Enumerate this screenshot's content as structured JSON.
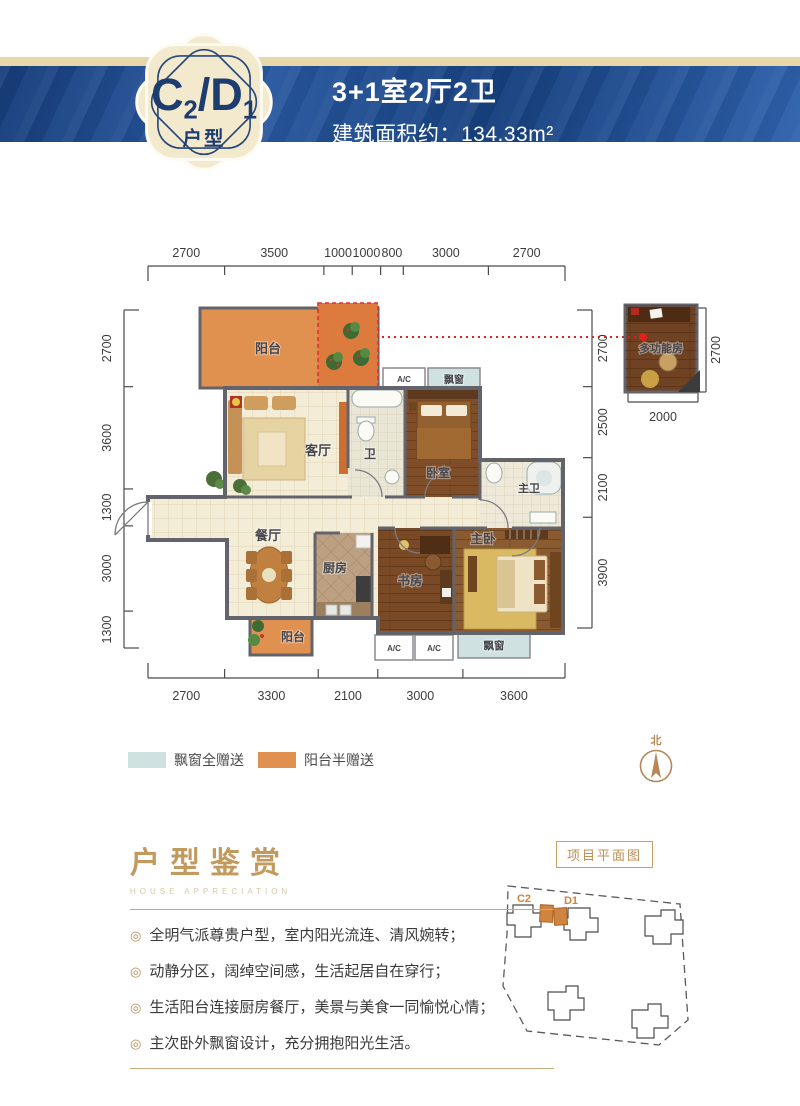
{
  "header": {
    "badge": {
      "parts": [
        "C",
        "2",
        "/D",
        "1"
      ],
      "label": "户型"
    },
    "title": "3+1室2厅2卫",
    "area_label": "建筑面积约：134.33m²"
  },
  "floorplan": {
    "rooms": {
      "balcony": "阳台",
      "living": "客厅",
      "bath": "卫",
      "bedroom": "卧室",
      "master_bath": "主卫",
      "dining": "餐厅",
      "kitchen": "厨房",
      "study": "书房",
      "master_bedroom": "主卧",
      "bay_window": "飘窗",
      "ac": "A/C",
      "annex": "多功能房"
    },
    "dims": {
      "top": [
        2700,
        3500,
        1000,
        1000,
        800,
        3000,
        2700
      ],
      "bottom": [
        2700,
        3300,
        2100,
        3000,
        3600
      ],
      "left": [
        2700,
        3600,
        1300,
        3000,
        1300
      ],
      "right": [
        2700,
        2500,
        2100,
        3900
      ],
      "annex_bottom": [
        2000
      ],
      "annex_right": [
        2700
      ]
    }
  },
  "legend": {
    "items": [
      {
        "label": "飘窗全赠送",
        "color": "#cfe2e1"
      },
      {
        "label": "阳台半赠送",
        "color": "#e0914f"
      }
    ]
  },
  "compass": {
    "label": "北"
  },
  "appreciation": {
    "title": "户型鉴赏",
    "subtitle": "HOUSE APPRECIATION",
    "bullets": [
      "全明气派尊贵户型，室内阳光流连、清风婉转；",
      "动静分区，阔绰空间感，生活起居自在穿行；",
      "生活阳台连接厨房餐厅，美景与美食一同愉悦心情；",
      "主次卧外飘窗设计，充分拥抱阳光生活。"
    ]
  },
  "siteplan": {
    "title": "项目平面图",
    "building_labels": [
      "C2",
      "D1"
    ]
  },
  "icons": {
    "bullet": "◎"
  },
  "colors": {
    "banner_blue": "#1c4788",
    "cream": "#e8d7a8",
    "badge_navy": "#1d3c70",
    "balcony_orange": "#e0914f",
    "gift_orange": "#dd7a3e",
    "bay_blue": "#cfe2e1",
    "gold_title": "#c29a5e",
    "wall_gray": "#63636b",
    "red_marker": "#e51f1f"
  }
}
